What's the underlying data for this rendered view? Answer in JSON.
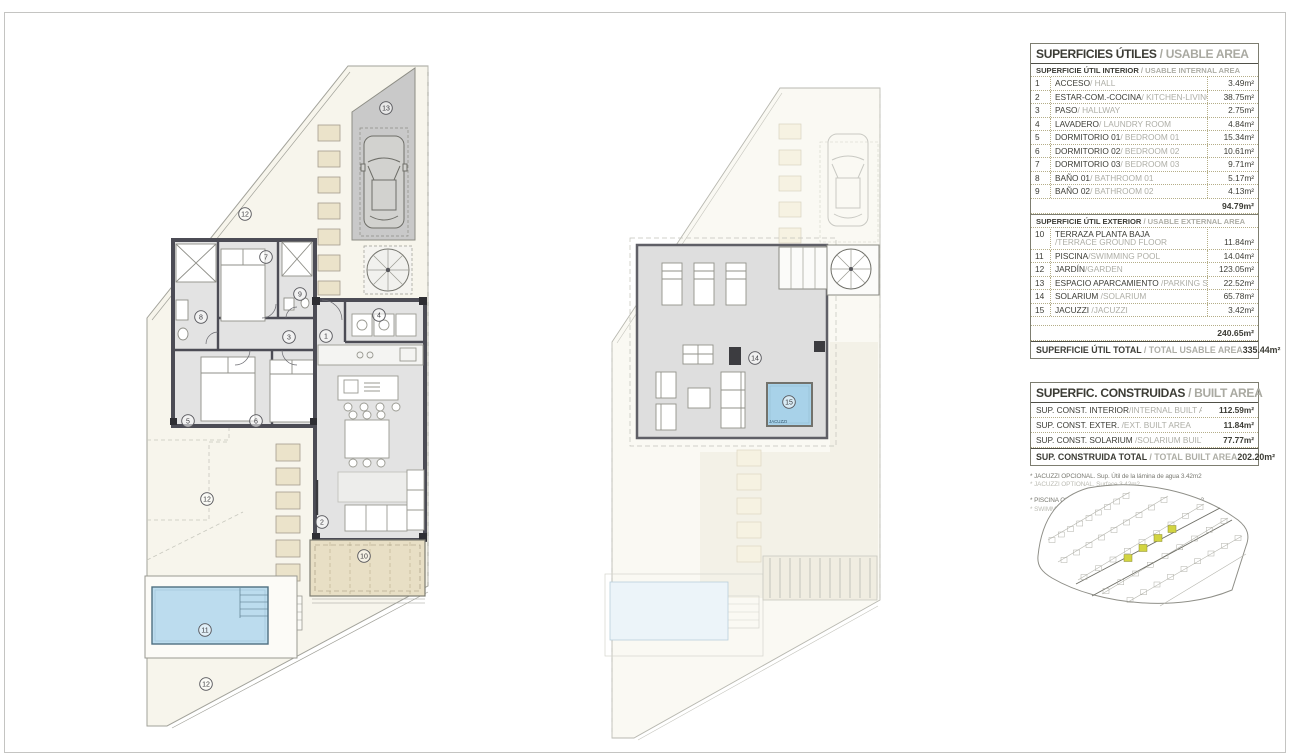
{
  "usable_table": {
    "title": "SUPERFICIES ÚTILES",
    "title_en": " / USABLE AREA",
    "interior_header": "SUPERFICIE ÚTIL INTERIOR",
    "interior_header_en": " / USABLE INTERNAL AREA",
    "interior_rows": [
      {
        "num": "1",
        "name": "ACCESO",
        "name_en": "/ HALL",
        "value": "3.49m²"
      },
      {
        "num": "2",
        "name": "ESTAR-COM.-COCINA",
        "name_en": "/ KITCHEN-LIVING",
        "value": "38.75m²"
      },
      {
        "num": "3",
        "name": "PASO",
        "name_en": "/ HALLWAY",
        "value": "2.75m²"
      },
      {
        "num": "4",
        "name": "LAVADERO",
        "name_en": "/ LAUNDRY ROOM",
        "value": "4.84m²"
      },
      {
        "num": "5",
        "name": "DORMITORIO 01",
        "name_en": "/ BEDROOM 01",
        "value": "15.34m²"
      },
      {
        "num": "6",
        "name": "DORMITORIO 02",
        "name_en": "/ BEDROOM 02",
        "value": "10.61m²"
      },
      {
        "num": "7",
        "name": "DORMITORIO 03",
        "name_en": "/ BEDROOM 03",
        "value": "9.71m²"
      },
      {
        "num": "8",
        "name": "BAÑO 01",
        "name_en": "/ BATHROOM 01",
        "value": "5.17m²"
      },
      {
        "num": "9",
        "name": "BAÑO 02",
        "name_en": "/ BATHROOM 02",
        "value": "4.13m²"
      }
    ],
    "interior_subtotal": "94.79m²",
    "exterior_header": "SUPERFICIE ÚTIL EXTERIOR",
    "exterior_header_en": " / USABLE EXTERNAL AREA",
    "exterior_rows": [
      {
        "num": "10",
        "name": "TERRAZA PLANTA BAJA",
        "name_en": "/TERRACE GROUND FLOOR",
        "value": "11.84m²",
        "two_line": true
      },
      {
        "num": "11",
        "name": "PISCINA",
        "name_en": "/SWIMMING POOL",
        "value": "14.04m²"
      },
      {
        "num": "12",
        "name": "JARDÍN",
        "name_en": "/GARDEN",
        "value": "123.05m²"
      },
      {
        "num": "13",
        "name": "ESPACIO APARCAMIENTO",
        "name_en": " /PARKING SPACE",
        "value": "22.52m²"
      },
      {
        "num": "14",
        "name": "SOLARIUM",
        "name_en": " /SOLARIUM",
        "value": "65.78m²"
      },
      {
        "num": "15",
        "name": "JACUZZI",
        "name_en": " /JACUZZI",
        "value": "3.42m²"
      }
    ],
    "exterior_subtotal": "240.65m²",
    "total_label": "SUPERFICIE ÚTIL TOTAL",
    "total_label_en": " / TOTAL USABLE AREA",
    "total_value": "335.44m²"
  },
  "built_table": {
    "title": "SUPERFIC. CONSTRUIDAS",
    "title_en": " / BUILT AREA",
    "rows": [
      {
        "name": "SUP. CONST. INTERIOR",
        "name_en": "/INTERNAL BUILT AREA",
        "value": "112.59m²"
      },
      {
        "name": "SUP. CONST. EXTER.",
        "name_en": " /EXT. BUILT AREA",
        "value": "11.84m²"
      },
      {
        "name": "SUP. CONST. SOLARIUM",
        "name_en": " /SOLARIUM BUILT AREA",
        "value": "77.77m²"
      }
    ],
    "total_label": "SUP. CONSTRUIDA TOTAL",
    "total_label_en": " / TOTAL BUILT AREA",
    "total_value": "202.20m²"
  },
  "notes": [
    {
      "text": "* JACUZZI OPCIONAL. Sup. Útil de la lámina de agua 3.42m2",
      "muted": false
    },
    {
      "text": "* JACUZZI OPTIONAL. Surface 3.42m2",
      "muted": true
    },
    {
      "text": "* PISCINA OPCIONAL. Sup. Útil de la lámina de agua 14.04m2",
      "muted": false
    },
    {
      "text": "* SWIMMING POOL OPTIONAL. Surface 14.04m2",
      "muted": true
    }
  ],
  "plans": {
    "ground": {
      "markers": [
        {
          "n": "1",
          "x": 326,
          "y": 336
        },
        {
          "n": "2",
          "x": 322,
          "y": 522
        },
        {
          "n": "3",
          "x": 289,
          "y": 337
        },
        {
          "n": "4",
          "x": 379,
          "y": 315
        },
        {
          "n": "5",
          "x": 188,
          "y": 421
        },
        {
          "n": "6",
          "x": 256,
          "y": 421
        },
        {
          "n": "7",
          "x": 266,
          "y": 257
        },
        {
          "n": "8",
          "x": 201,
          "y": 317
        },
        {
          "n": "9",
          "x": 300,
          "y": 294
        },
        {
          "n": "10",
          "x": 364,
          "y": 556
        },
        {
          "n": "11",
          "x": 205,
          "y": 630
        },
        {
          "n": "12",
          "x": 245,
          "y": 214
        },
        {
          "n": "12",
          "x": 207,
          "y": 499
        },
        {
          "n": "12",
          "x": 206,
          "y": 684
        },
        {
          "n": "13",
          "x": 386,
          "y": 108
        }
      ]
    },
    "roof": {
      "markers": [
        {
          "n": "14",
          "x": 755,
          "y": 358
        },
        {
          "n": "15",
          "x": 789,
          "y": 402
        }
      ],
      "jacuzzi_label": "JACUZZI"
    }
  },
  "colors": {
    "pool_blue": "#bcdcee",
    "jacuzzi_blue": "#a8d2e9",
    "terrace_beige": "#e8dfc5",
    "stone_beige": "#ece4cb",
    "wall_dark": "#4c4c55",
    "floor_gray": "#e3e3e3",
    "parking_gray": "#c9c9c9",
    "highlight_yellow": "#d2d441",
    "table_line_olive": "#b5ae88"
  }
}
